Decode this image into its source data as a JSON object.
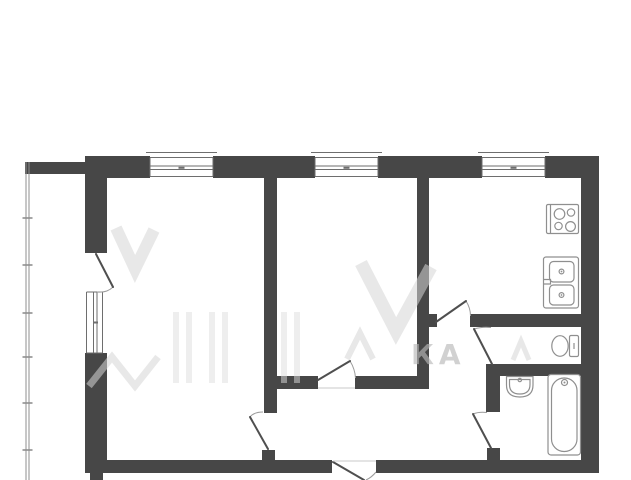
{
  "colors": {
    "bg": "#ffffff",
    "wall": "#474747",
    "line": "#4f4f4f",
    "frame": "#6e6e6e",
    "arc": "#9b9b9b",
    "threshold": "#c8c8c8",
    "balcony": "#8f8f8f",
    "fixture": "#8f8f8f"
  },
  "watermark": {
    "visible_letters": "КА"
  },
  "plan": {
    "walls": [
      {
        "name": "top-wall-balcony-segment",
        "x": 25,
        "y": 162,
        "w": 67,
        "h": 12
      },
      {
        "name": "top-wall-segment-a",
        "x": 92,
        "y": 156,
        "w": 58,
        "h": 22
      },
      {
        "name": "top-wall-segment-b",
        "x": 213,
        "y": 156,
        "w": 102,
        "h": 22
      },
      {
        "name": "top-wall-segment-c",
        "x": 378,
        "y": 156,
        "w": 104,
        "h": 22
      },
      {
        "name": "top-wall-segment-d",
        "x": 545,
        "y": 156,
        "w": 54,
        "h": 22
      },
      {
        "name": "left-wall-upper",
        "x": 85,
        "y": 156,
        "w": 22,
        "h": 97
      },
      {
        "name": "left-wall-lower",
        "x": 85,
        "y": 353,
        "w": 22,
        "h": 110
      },
      {
        "name": "right-wall",
        "x": 581,
        "y": 156,
        "w": 18,
        "h": 317
      },
      {
        "name": "bottom-wall-west",
        "x": 85,
        "y": 460,
        "w": 247,
        "h": 13
      },
      {
        "name": "bottom-wall-east",
        "x": 376,
        "y": 460,
        "w": 223,
        "h": 13
      },
      {
        "name": "bottom-left-stub",
        "x": 90,
        "y": 473,
        "w": 13,
        "h": 7
      },
      {
        "name": "room-divider-wall",
        "x": 264,
        "y": 178,
        "w": 13,
        "h": 235
      },
      {
        "name": "room1-door-stub",
        "x": 262,
        "y": 450,
        "w": 13,
        "h": 10
      },
      {
        "name": "hallway-wall-west",
        "x": 277,
        "y": 376,
        "w": 41,
        "h": 13
      },
      {
        "name": "hallway-wall-east",
        "x": 355,
        "y": 376,
        "w": 73,
        "h": 13
      },
      {
        "name": "kitchen-divider-wall",
        "x": 417,
        "y": 178,
        "w": 12,
        "h": 211
      },
      {
        "name": "kitchen-south-stub",
        "x": 429,
        "y": 314,
        "w": 8,
        "h": 13
      },
      {
        "name": "kitchen-south-wall",
        "x": 470,
        "y": 314,
        "w": 111,
        "h": 13
      },
      {
        "name": "wc-south-wall",
        "x": 486,
        "y": 364,
        "w": 95,
        "h": 12
      },
      {
        "name": "bathroom-west-wall",
        "x": 486,
        "y": 364,
        "w": 14,
        "h": 48
      },
      {
        "name": "bathroom-door-stub",
        "x": 487,
        "y": 448,
        "w": 13,
        "h": 12
      }
    ],
    "windows": [
      {
        "name": "window-room1-top",
        "type": "h",
        "x1": 150,
        "x2": 213
      },
      {
        "name": "window-room2-top",
        "type": "h",
        "x1": 315,
        "x2": 378
      },
      {
        "name": "window-kitchen-top",
        "type": "h",
        "x1": 482,
        "x2": 545
      },
      {
        "name": "window-room1-side",
        "type": "v",
        "y1": 292,
        "y2": 353
      }
    ],
    "doors": [
      {
        "name": "door-balcony",
        "leaf": [
          96,
          254,
          113,
          287
        ],
        "arc": "M113,287 Q107,293 97,292"
      },
      {
        "name": "door-room1",
        "leaf": [
          268,
          449,
          250,
          417
        ],
        "arc": "M250,417 Q254,412 263,412"
      },
      {
        "name": "door-room2",
        "leaf": [
          318,
          380,
          350,
          361
        ],
        "arc": "M350,361 Q355,369 355.5,378"
      },
      {
        "name": "door-kitchen",
        "leaf": [
          436,
          322,
          466,
          301
        ],
        "arc": "M466,301 Q470.5,308 470.5,316"
      },
      {
        "name": "door-wc",
        "leaf": [
          492,
          364,
          474,
          329
        ],
        "arc": "M474,329 Q482,326.5 491,327.5"
      },
      {
        "name": "door-bathroom",
        "leaf": [
          491,
          448,
          473,
          414
        ],
        "arc": "M473,414 Q479,411.5 487,412.5"
      },
      {
        "name": "door-entrance",
        "leaf": [
          333,
          462,
          364,
          480
        ],
        "arc": "M376,472 Q371.5,477.5 366,480"
      }
    ],
    "thresholds": [
      {
        "name": "threshold-room2-door",
        "line": [
          318,
          388,
          355,
          388
        ]
      },
      {
        "name": "threshold-entrance-door",
        "line": [
          333,
          461,
          376,
          461
        ]
      }
    ],
    "balcony": {
      "rails_x": [
        26,
        29
      ],
      "y1": 162,
      "y2": 480,
      "ticks_y": [
        218,
        265,
        313,
        357,
        403,
        450
      ]
    },
    "fixtures": [
      {
        "name": "stove"
      },
      {
        "name": "kitchen-sink"
      },
      {
        "name": "toilet"
      },
      {
        "name": "washbasin"
      },
      {
        "name": "bathtub"
      }
    ]
  }
}
